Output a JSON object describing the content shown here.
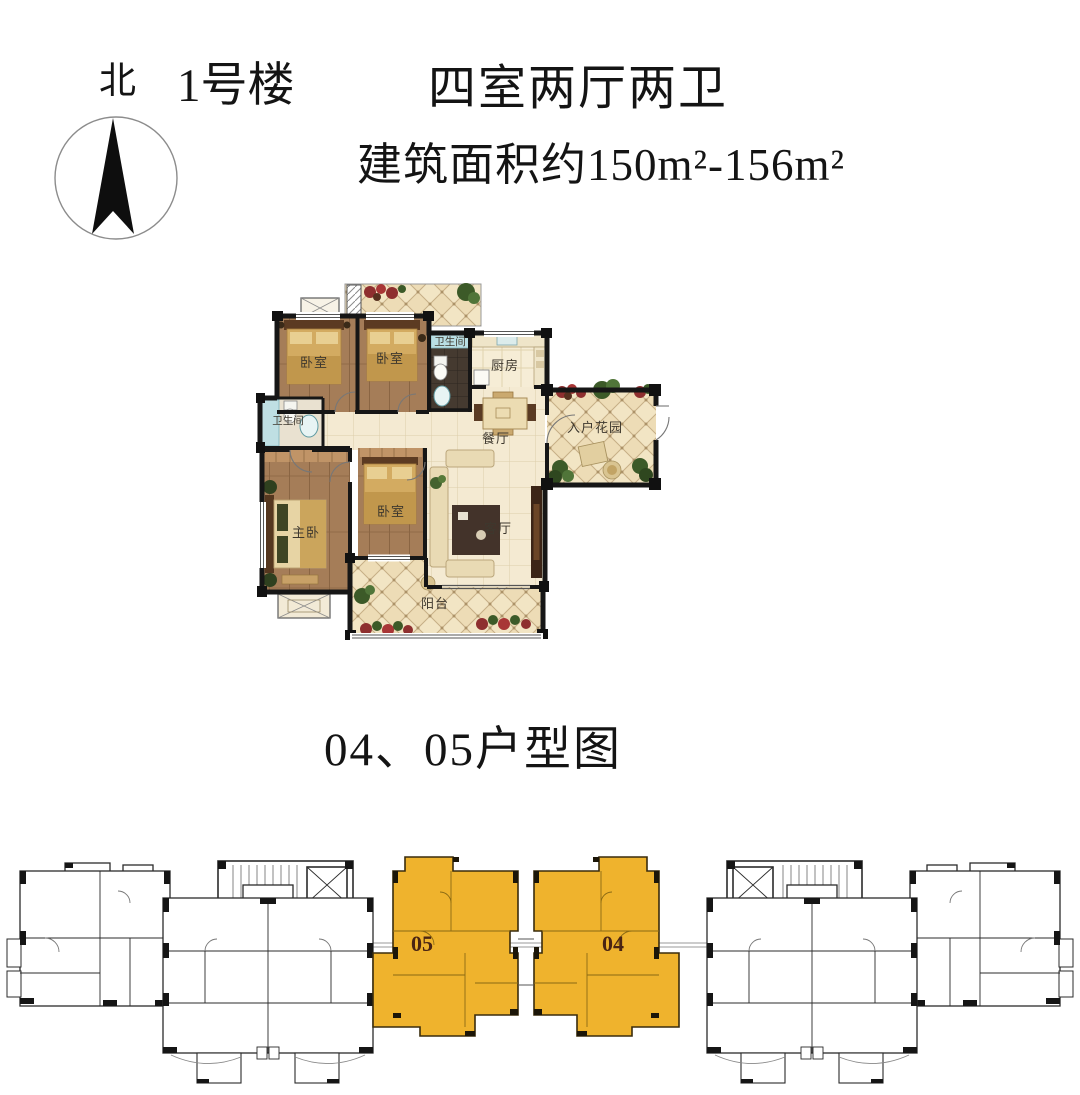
{
  "header": {
    "north_label": "北",
    "building_label": "1号楼",
    "title": "四室两厅两卫",
    "area": "建筑面积约150m²-156m²"
  },
  "floorplan": {
    "rooms": {
      "bedroom_a": "卧室",
      "bedroom_b": "卧室",
      "bathroom_top": "卫生间",
      "kitchen": "厨房",
      "dining": "餐厅",
      "entry_garden": "入户花园",
      "bathroom_left": "卫生间",
      "master_bedroom": "主卧",
      "bedroom_c": "卧室",
      "living": "客厅",
      "balcony": "阳台"
    }
  },
  "section_title": "04、05户型图",
  "keyplan": {
    "unit_left_label": "05",
    "unit_right_label": "04",
    "highlight_color": "#efb32d",
    "label_color": "#4a2413"
  }
}
